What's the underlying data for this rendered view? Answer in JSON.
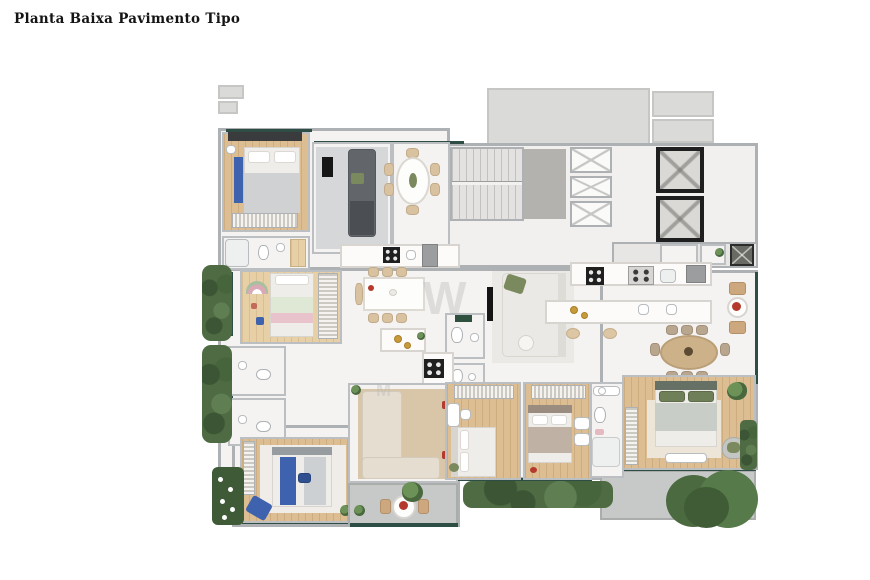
{
  "page": {
    "title": "Planta Baixa Pavimento Tipo",
    "background": "#ffffff"
  },
  "watermark": {
    "letter_large": "W",
    "letter_small": "M"
  },
  "palette": {
    "wall": "#aeb1b3",
    "wall_light": "#bcbfc1",
    "floor_white": "#f4f3f1",
    "wood": "#dcbe92",
    "wood_light": "#e7cfa6",
    "window_teal": "#2e4d44",
    "hedge_green": "#4e6b43",
    "hedge_dark": "#3c5635",
    "accent_blue": "#3f62ae",
    "accent_green": "#7b8a5e",
    "accent_red": "#b53a2e",
    "rug_tan": "#d9c6a8",
    "rug_gray": "#d6d7d9",
    "rug_cream": "#ece5d8",
    "sofa_dark": "#62656a",
    "sofa_beige": "#e4ddd0",
    "sofa_white": "#ebe9e5",
    "bed_taupe": "#bfb2a4",
    "bed_green": "#6f7f58",
    "concrete": "#c6c9c7",
    "slab": "#b3b2af",
    "appliance_gray": "#9b9d9f",
    "elevator_frame": "#1f1f1f"
  }
}
